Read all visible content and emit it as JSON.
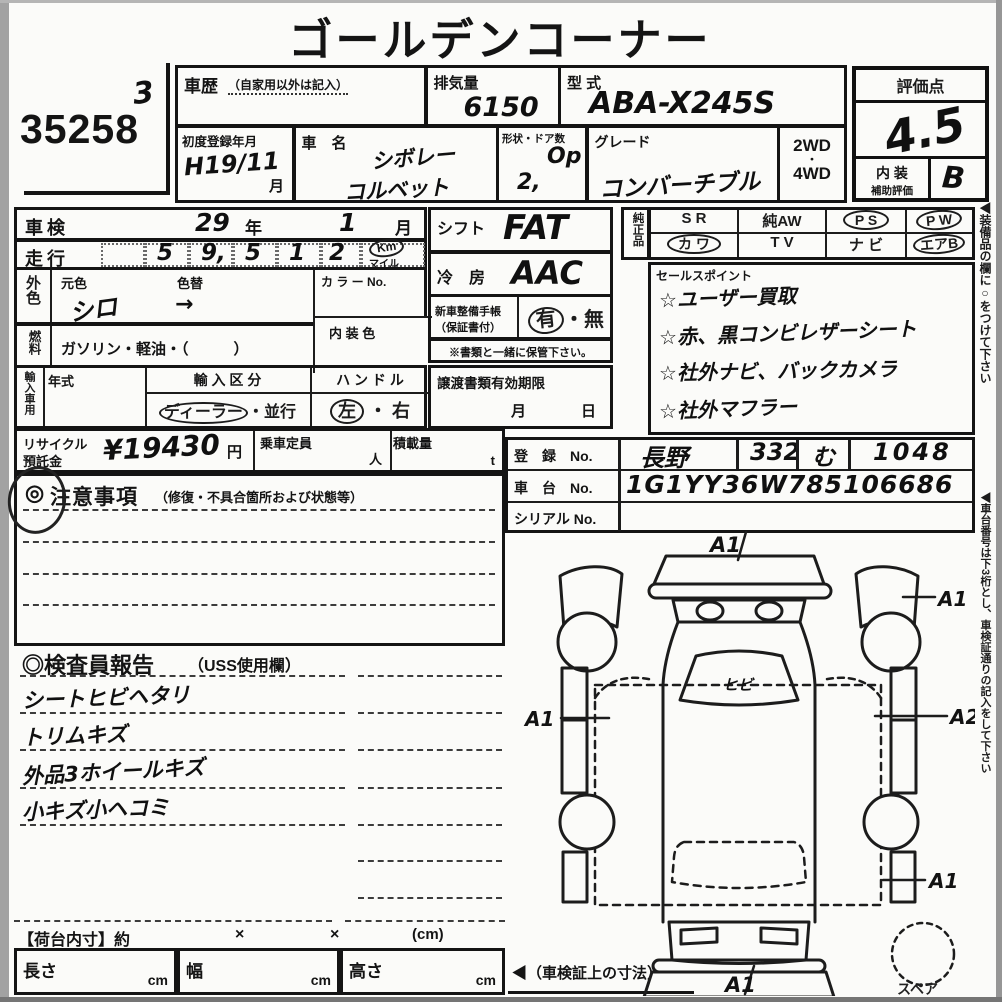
{
  "page": {
    "title": "ゴールデンコーナー",
    "auction_no": "35258",
    "lane_mark": "3"
  },
  "head": {
    "history_label": "車歴",
    "history_note": "（自家用以外は記入）",
    "displacement_label": "排気量",
    "displacement_value": "6150",
    "model_code_label": "型  式",
    "model_code_value": "ABA-X245S",
    "first_reg_label": "初度登録年月",
    "first_reg_value": "H19/11",
    "first_reg_suffix": "月",
    "name_label": "車　名",
    "name_line1": "シボレー",
    "name_line2": "コルベット",
    "body_doors_label": "形状・ドア数",
    "body_doors_opt": "Op",
    "body_doors_num": "2,",
    "grade_label": "グレード",
    "grade_value": "コンバーチブル",
    "drive_2wd": "2WD",
    "drive_dot": "・",
    "drive_4wd": "4WD"
  },
  "score": {
    "label": "評価点",
    "value": "4.5",
    "interior_label": "内 装",
    "interior_sublabel": "補助評価",
    "interior_value": "B"
  },
  "left": {
    "shaken_label": "車検",
    "shaken_year": "29",
    "year_unit": "年",
    "shaken_month": "1",
    "month_unit": "月",
    "mileage_label": "走行",
    "d1": "5",
    "d2": "9,",
    "d3": "5",
    "d4": "1",
    "d5": "2",
    "unit_km": "Km",
    "unit_mile": "マイル",
    "ext_color_label": "外色",
    "orig_color_label": "元色",
    "color_change_label": "色替",
    "orig_color_value": "シロ",
    "color_change_value": "→",
    "color_no_label": "カ ラ ー No.",
    "fuel_label": "燃料",
    "fuel_value": "ガソリン・軽油・（　　　）",
    "interior_color_label": "内 装 色",
    "import_label": "輸入車用",
    "year_type_label": "年式",
    "import_class_label": "輸 入 区 分",
    "import_dealer": "ディーラー",
    "import_sep": "・",
    "import_parallel": "並行",
    "handle_label": "ハ ン ド ル",
    "handle_left": "左",
    "handle_sep": "・",
    "handle_right": "右",
    "recycle_label1": "リサイクル",
    "recycle_label2": "預託金",
    "recycle_value": "¥19430",
    "yen_unit": "円",
    "capacity_label": "乗車定員",
    "capacity_unit": "人",
    "load_label": "積載量",
    "load_unit": "t"
  },
  "middle": {
    "shift_label": "シフト",
    "shift_value": "FAT",
    "ac_label": "冷　房",
    "ac_value": "AAC",
    "book_label1": "新車整備手帳",
    "book_label2": "（保証書付）",
    "book_yes": "有",
    "book_sep": "・",
    "book_no": "無",
    "keep_note": "※書類と一緒に保管下さい。",
    "transfer_label": "譲渡書類有効期限",
    "transfer_month": "月",
    "transfer_day": "日"
  },
  "equipment": {
    "genuine_label": "純正品",
    "r1c1": "S R",
    "r1c2": "純AW",
    "r1c3": "P S",
    "r1c4": "P W",
    "r2c1": "カ ワ",
    "r2c2": "T V",
    "r2c3": "ナ ビ",
    "r2c4": "エアB"
  },
  "sales": {
    "label": "セールスポイント",
    "item1": "☆ユーザー買取",
    "item2": "☆赤、黒コンビレザーシート",
    "item3": "☆社外ナビ、バックカメラ",
    "item4": "☆社外マフラー"
  },
  "registration": {
    "reg_label": "登　録　No.",
    "reg_area": "長野",
    "reg_class": "332",
    "reg_kana": "む",
    "reg_number": "1048",
    "chassis_label": "車　台　No.",
    "chassis_value": "1G1YY36W785106686",
    "serial_label": "シリアル No."
  },
  "cautions": {
    "mark": "◎",
    "label": "注意事項",
    "sublabel": "（修復・不具合箇所および状態等）"
  },
  "report": {
    "label": "◎検査員報告",
    "sublabel": "（USS使用欄）",
    "item1": "シートヒビヘタリ",
    "item2": "トリムキズ",
    "item3": "外品3ホイールキズ",
    "item4": "小キズ小ヘコミ"
  },
  "cargo": {
    "label": "【荷台内寸】約",
    "times1": "×",
    "times2": "×",
    "unit": "(cm)",
    "length_label": "長さ",
    "width_label": "幅",
    "height_label": "高さ",
    "cm1": "cm",
    "cm2": "cm",
    "cm3": "cm",
    "arrow_note": "◀（車検証上の寸法）"
  },
  "diagram": {
    "mark_front": "A1",
    "mark_right_front": "A1",
    "mark_left": "A1",
    "mark_right": "A2",
    "mark_right_rear": "A1",
    "mark_rear": "A1",
    "windshield_note": "ヒビ",
    "spare_label": "スペア"
  },
  "side_notes": {
    "note1": "◀装備品の欄に○をつけて下さい",
    "note2": "◀車台番号は下3桁とし、車検証通りの記入をして下さい"
  },
  "colors": {
    "ink": "#1c1c1c",
    "paper": "#fbfbf9",
    "scan_edge": "#9e9e9e"
  }
}
